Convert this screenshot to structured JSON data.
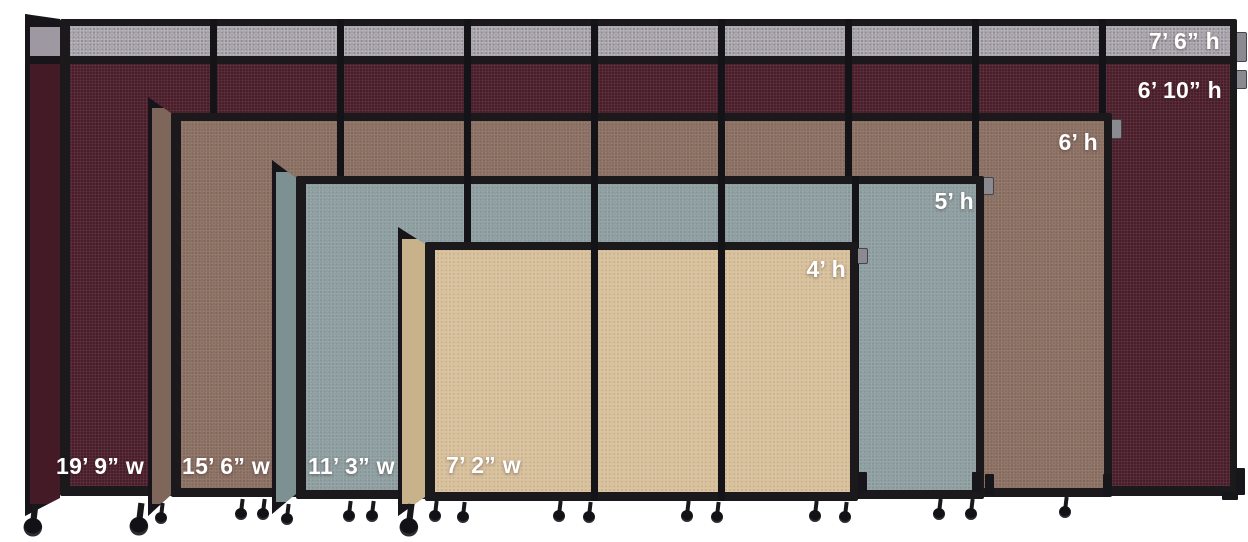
{
  "image": {
    "background_hex": "#ffffff",
    "frame_hex": "#1b191c",
    "partitions": [
      {
        "name": "largest-burgundy-partition",
        "width": "19’ 9” w",
        "height_with_topper": "7’ 6” h",
        "height": "6’ 10” h",
        "fabric_hex": "#4c1e2c",
        "return_hex": "#451a27",
        "topper_strip_hex": "#a7a2aa"
      },
      {
        "name": "brown-partition",
        "width": "15’ 6” w",
        "height": "6’ h",
        "fabric_hex": "#8b6f62",
        "return_hex": "#7f665a"
      },
      {
        "name": "blue-gray-partition",
        "width": "11’ 3” w",
        "height": "5’ h",
        "fabric_hex": "#8f9fa1",
        "return_hex": "#7d9193"
      },
      {
        "name": "beige-partition",
        "width": "7’ 2” w",
        "height": "4’ h",
        "fabric_hex": "#d8c09b",
        "return_hex": "#c8b28c"
      }
    ]
  }
}
